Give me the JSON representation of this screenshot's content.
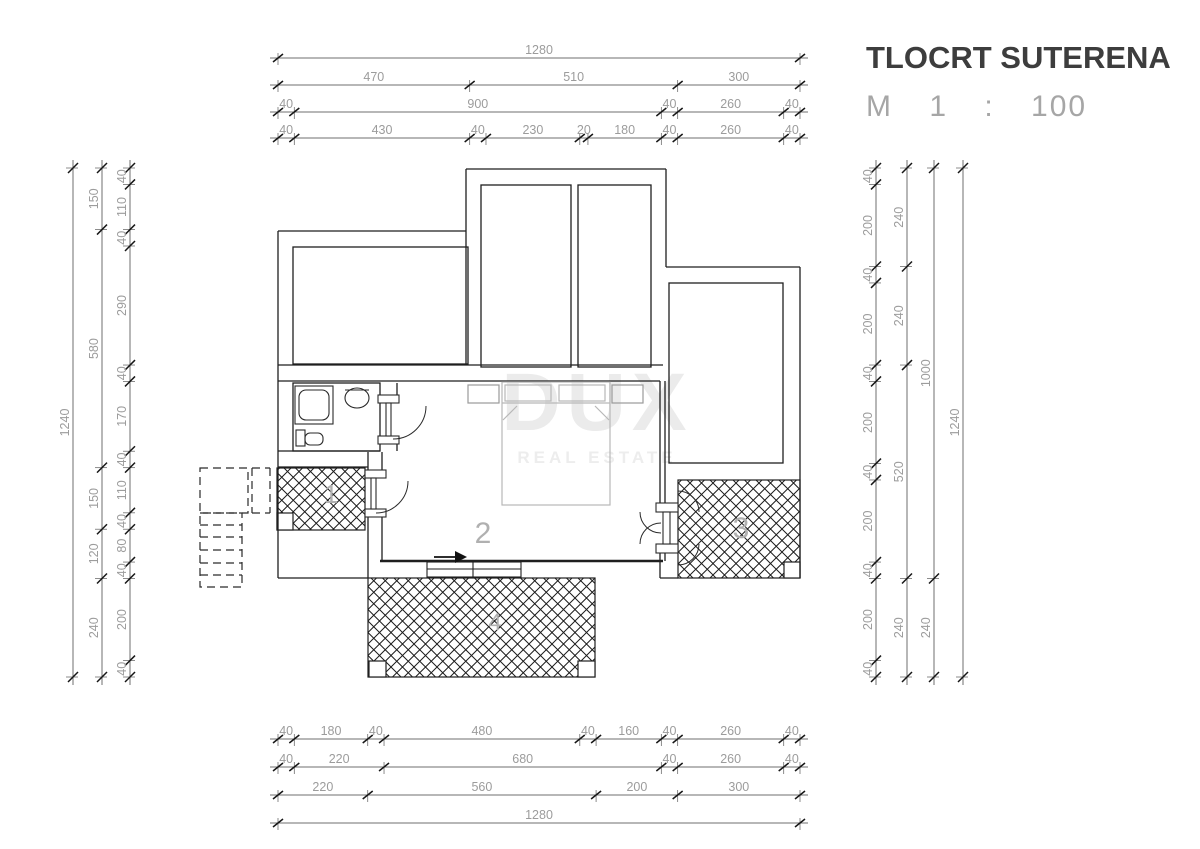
{
  "title": {
    "heading": "TLOCRT SUTERENA",
    "scale": "M 1 : 100"
  },
  "watermark": {
    "name": "DUX",
    "tagline": "REAL ESTATE"
  },
  "rooms": [
    {
      "label": "1"
    },
    {
      "label": "2"
    },
    {
      "label": "3"
    },
    {
      "label": "4"
    }
  ],
  "dimensions": {
    "top_rows": [
      [
        1280
      ],
      [
        470,
        510,
        300
      ],
      [
        40,
        900,
        40,
        260,
        40
      ],
      [
        40,
        430,
        40,
        230,
        20,
        180,
        40,
        260,
        40
      ]
    ],
    "bottom_rows": [
      [
        40,
        180,
        40,
        480,
        40,
        160,
        40,
        260,
        40
      ],
      [
        40,
        220,
        680,
        40,
        260,
        40
      ],
      [
        220,
        560,
        200,
        300
      ],
      [
        1280
      ]
    ],
    "left_cols": [
      [
        1240
      ],
      [
        150,
        580,
        150,
        120,
        240
      ],
      [
        40,
        110,
        40,
        290,
        40,
        170,
        40,
        110,
        40,
        80,
        40,
        200,
        40
      ]
    ],
    "right_cols": [
      [
        40,
        200,
        40,
        200,
        40,
        200,
        40,
        200,
        40,
        200,
        40
      ],
      [
        240,
        240,
        520,
        240
      ],
      [
        1000,
        240
      ],
      [
        1240
      ]
    ]
  },
  "colors": {
    "wall": "#1f1f1f",
    "dim_line": "#6f6f6f",
    "dim_text": "#9c9c9c",
    "tick": "#161616",
    "furniture": "#b8b8b8",
    "room_label": "#b0b0b0",
    "watermark": "#ebebeb",
    "title": "#3d3d3d",
    "scale_text": "#a6a6a6",
    "background": "#ffffff"
  }
}
